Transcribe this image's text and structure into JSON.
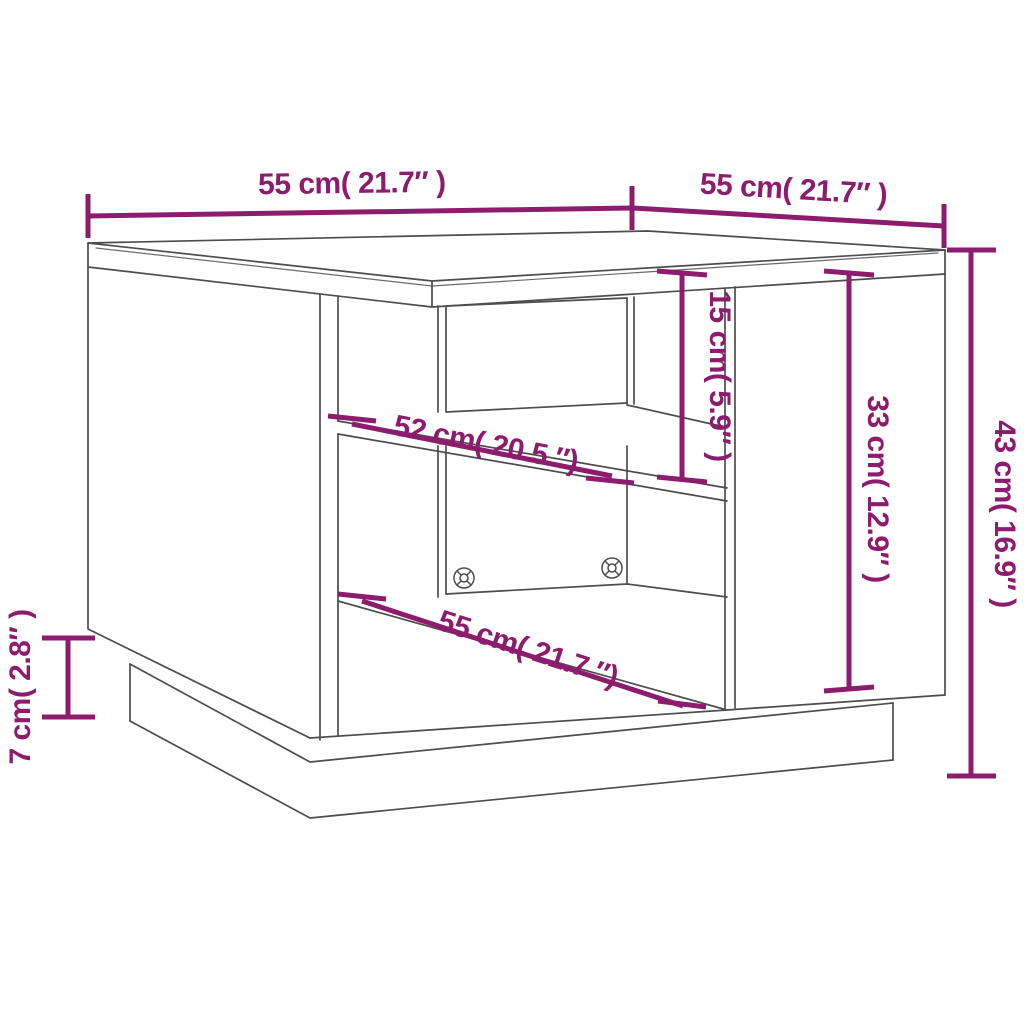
{
  "page": {
    "type": "furniture dimension diagram",
    "subject": "coffee table with open shelf compartments, side door panel and recessed plinth base",
    "background": "#ffffff"
  },
  "colors": {
    "dimension_annotation": "#8E1C6E",
    "drawing_outline": "#4D4D4D"
  },
  "screws": {
    "count": 2
  },
  "dimensions": {
    "top_width": {
      "label": "55 cm( 21.7″ )"
    },
    "top_depth": {
      "label": "55 cm( 21.7″ )"
    },
    "overall_height": {
      "label": "43 cm( 16.9″ )"
    },
    "shelf_opening_height": {
      "label": "15 cm( 5.9″ )"
    },
    "door_panel_height": {
      "label": "33 cm( 12.9″ )"
    },
    "middle_shelf_width": {
      "label": "52 cm( 20.5 ″)"
    },
    "bottom_shelf_width": {
      "label": "55 cm( 21.7 ″)"
    },
    "plinth_height": {
      "label": "7 cm( 2.8″ )"
    }
  }
}
